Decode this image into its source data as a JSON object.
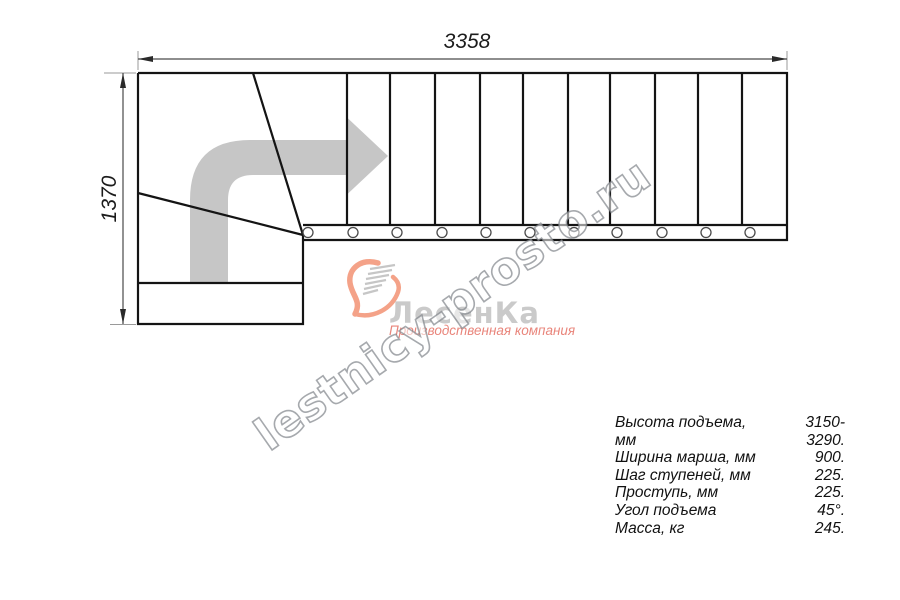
{
  "drawing": {
    "dim_width": "3358",
    "dim_height": "1370"
  },
  "watermark": {
    "text": "lestnicy-prosto.ru"
  },
  "logo": {
    "name": "ЛесенКа",
    "tagline": "Производственная компания"
  },
  "specs": {
    "rows": [
      {
        "label": "Высота подъема, мм",
        "value": "3150-3290."
      },
      {
        "label": "Ширина марша, мм",
        "value": "900."
      },
      {
        "label": "Шаг ступеней, мм",
        "value": "225."
      },
      {
        "label": "Проступь, мм",
        "value": "225."
      },
      {
        "label": "Угол подъема",
        "value": "45°."
      },
      {
        "label": "Масса, кг",
        "value": "245."
      }
    ]
  },
  "colors": {
    "outline": "#141414",
    "dimension": "#4a4a4a",
    "extension": "#9a9a9a",
    "arrow_gray": "#c6c6c6",
    "logo_salmon": "#f4a288",
    "logo_gray": "#cacaca",
    "logo_tagline": "#e9857b"
  }
}
